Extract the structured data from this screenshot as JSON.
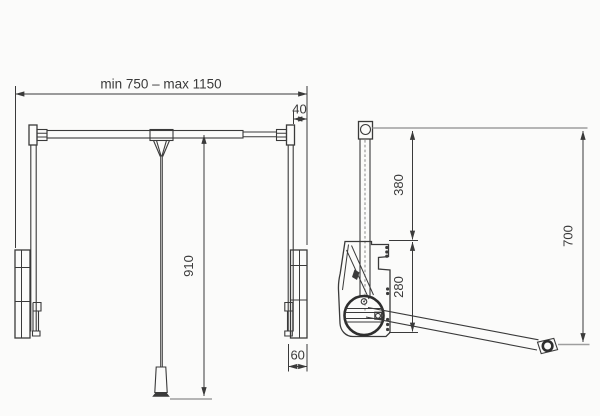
{
  "colors": {
    "line": "#3a3a3a",
    "reference_line": "#9e9e9e",
    "text": "#3a3a3a",
    "background": "#fbfbfa"
  },
  "front_view": {
    "width_dimension": "min 750 – max 1150",
    "plate_offset_dimension": "40",
    "drop_dimension": "910",
    "bracket_depth_dimension": "60"
  },
  "side_view": {
    "upper_dimension": "380",
    "lower_dimension": "280",
    "overall_dimension": "700"
  }
}
